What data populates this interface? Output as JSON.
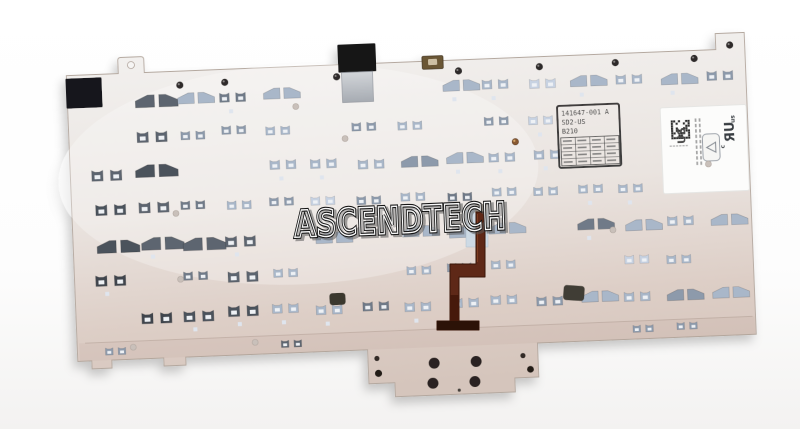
{
  "photo": {
    "watermark_text": "ASCENDTECH",
    "part_stamp": {
      "line1": "141647-001 A",
      "line2": "SD2-US",
      "line3": "B210"
    },
    "regulatory_sticker": {
      "region_code": "US",
      "ul_mark": "ЯU",
      "ul_mark_prefix": "c",
      "ul_mark_suffix": "us"
    }
  },
  "colors": {
    "background": "#ffffff",
    "plate_light": "#f2f0ee",
    "plate_mid": "#e8e1dc",
    "plate_warm": "#d7c8c0",
    "plate_edge": "#b4a89f",
    "tape_black": "#17171a",
    "tape_strip_light": "#d2d5d9",
    "tape_strip_dark": "#a6abb2",
    "clip_light_palette": [
      "#a9b7c9",
      "#8d9aab",
      "#c7d2e2",
      "#6f7a88"
    ],
    "clip_dark_palette": [
      "#4b525c",
      "#5d656f",
      "#3f454d"
    ],
    "clip_inner": "#eef1f5",
    "tiny_square": "#dfe5ee",
    "cable_brown": "#5e2817",
    "cable_dark": "#2c1207",
    "cable_mid": "#46190b",
    "stiffener_blue": "#ccdae6",
    "stamp_ink": "#3d3d3d",
    "stamp_border": "#2b2b2b",
    "sticker_white": "#fcfcfb",
    "screw_dome": "#2e2b29",
    "emboss_dot": "#c9c0ba",
    "rivet_copper": "#8a5a33"
  }
}
